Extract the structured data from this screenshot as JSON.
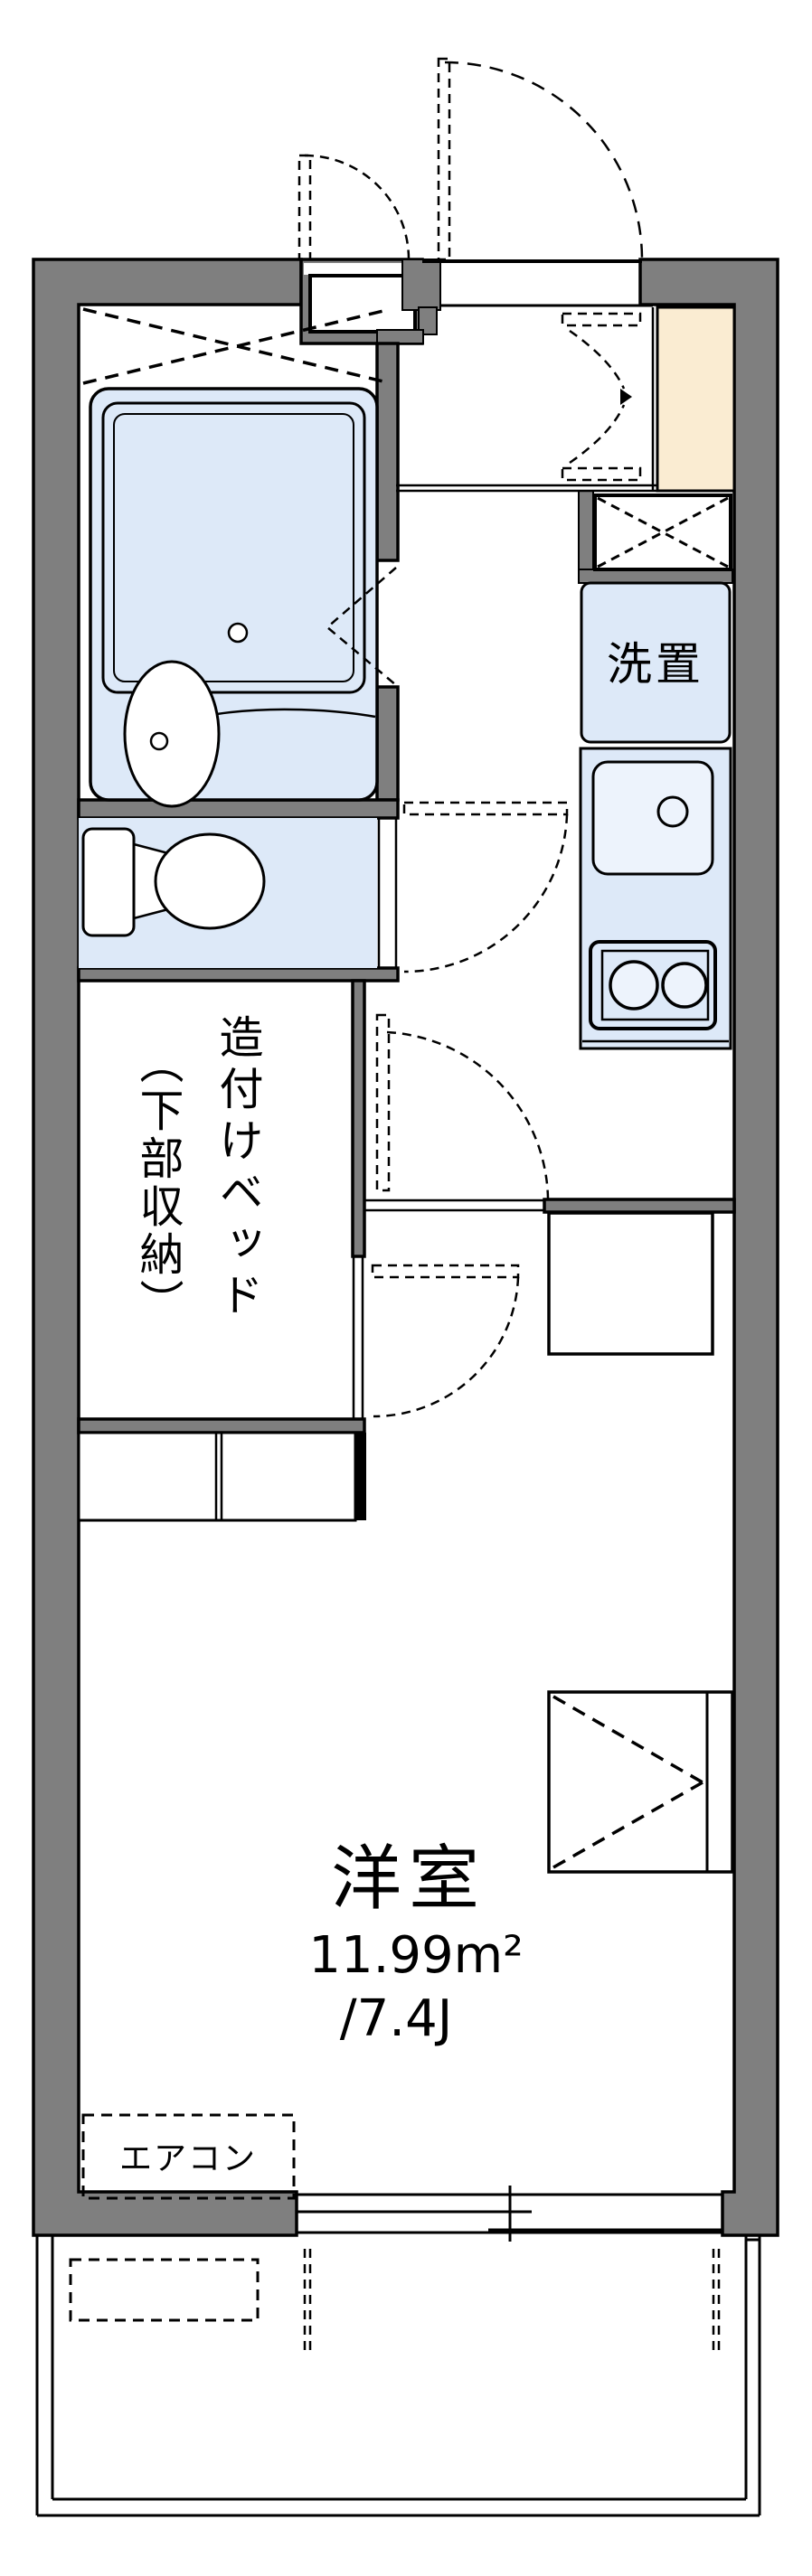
{
  "floorplan": {
    "rooms": {
      "main_room": {
        "name": "洋室",
        "area_m2": "11.99m²",
        "area_tatami": "/7.4J"
      },
      "laundry_space": {
        "label": "洗置"
      },
      "built_in_bed": {
        "label_line1": "造付けベッド",
        "label_line2": "（下部収納）"
      },
      "air_conditioner": {
        "label": "エアコン"
      }
    },
    "colors": {
      "wall": "#7f7f7f",
      "fixture_blue": "#dde9f8",
      "fixture_blue_light": "#edf3fc",
      "genkan_beige": "#faecd2",
      "line": "#000000",
      "bg": "#ffffff"
    }
  }
}
